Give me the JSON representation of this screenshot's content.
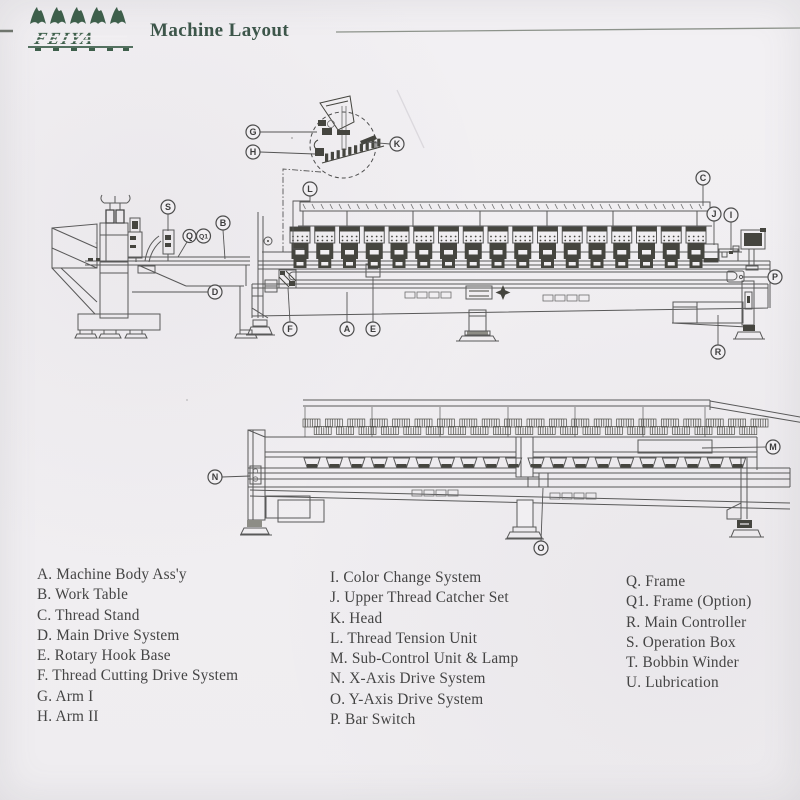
{
  "header": {
    "brand": "FEIYA",
    "title": "Machine Layout"
  },
  "legend": {
    "columns": [
      {
        "items": [
          "A. Machine Body Ass'y",
          "B. Work Table",
          "C. Thread Stand",
          "D. Main Drive System",
          "E. Rotary Hook Base",
          "F. Thread Cutting Drive System",
          "G. Arm I",
          "H. Arm II"
        ]
      },
      {
        "items": [
          "I. Color Change System",
          "J. Upper Thread Catcher Set",
          "K. Head",
          "L. Thread Tension Unit",
          "M. Sub-Control Unit & Lamp",
          "N. X-Axis Drive System",
          "O. Y-Axis Drive System",
          "P. Bar Switch"
        ]
      },
      {
        "items": [
          "Q. Frame",
          "Q1. Frame (Option)",
          "R. Main Controller",
          "S. Operation Box",
          "T. Bobbin Winder",
          "U. Lubrication"
        ]
      }
    ]
  },
  "diagram": {
    "machine": {
      "heads": 17,
      "thread_cone_groups": 41,
      "hook_bases": 20
    },
    "callouts": [
      {
        "letter": "G",
        "x": 253,
        "y": 132,
        "r": 7,
        "leader": [
          260,
          132,
          317,
          132
        ]
      },
      {
        "letter": "H",
        "x": 253,
        "y": 152,
        "r": 7,
        "leader": [
          260,
          152,
          315,
          154
        ]
      },
      {
        "letter": "K",
        "x": 397,
        "y": 144,
        "r": 7,
        "leader": [
          390,
          144,
          367,
          142
        ]
      },
      {
        "letter": "L",
        "x": 310,
        "y": 189,
        "r": 7,
        "leader": [
          310,
          196,
          310,
          201,
          293,
          201,
          293,
          249,
          304,
          249
        ]
      },
      {
        "letter": "C",
        "x": 703,
        "y": 178,
        "r": 7,
        "leader": [
          703,
          185,
          703,
          206
        ]
      },
      {
        "letter": "J",
        "x": 714,
        "y": 214,
        "r": 7,
        "leader": [
          714,
          221,
          714,
          245
        ]
      },
      {
        "letter": "I",
        "x": 731,
        "y": 215,
        "r": 7,
        "leader": [
          731,
          222,
          731,
          250
        ]
      },
      {
        "letter": "P",
        "x": 775,
        "y": 277,
        "r": 7,
        "leader": [
          768,
          277,
          742,
          277
        ]
      },
      {
        "letter": "S",
        "x": 168,
        "y": 207,
        "r": 7,
        "leader": [
          168,
          214,
          168,
          231
        ]
      },
      {
        "letter": "Q",
        "x": 189.5,
        "y": 236,
        "r": 6.5,
        "leader": [
          187,
          242,
          178,
          257
        ]
      },
      {
        "letter": "Q1",
        "x": 203.5,
        "y": 236,
        "r": 7,
        "leader": []
      },
      {
        "letter": "B",
        "x": 223,
        "y": 223,
        "r": 7,
        "leader": [
          223,
          230,
          225,
          259
        ]
      },
      {
        "letter": "D",
        "x": 215,
        "y": 292,
        "r": 7,
        "leader": [
          208,
          292,
          132,
          292
        ]
      },
      {
        "letter": "F",
        "x": 290,
        "y": 329,
        "r": 7,
        "leader": [
          290,
          322,
          288,
          288
        ]
      },
      {
        "letter": "A",
        "x": 347,
        "y": 329,
        "r": 7,
        "leader": [
          347,
          322,
          347,
          292
        ]
      },
      {
        "letter": "E",
        "x": 373,
        "y": 329,
        "r": 7,
        "leader": [
          373,
          322,
          373,
          277
        ]
      },
      {
        "letter": "R",
        "x": 718,
        "y": 352,
        "r": 7,
        "leader": [
          718,
          345,
          718,
          315
        ]
      },
      {
        "letter": "N",
        "x": 215,
        "y": 477,
        "r": 7,
        "leader": [
          222,
          477,
          250,
          476
        ]
      },
      {
        "letter": "M",
        "x": 773,
        "y": 447,
        "r": 7,
        "leader": [
          766,
          447,
          702,
          448
        ]
      },
      {
        "letter": "O",
        "x": 541,
        "y": 548,
        "r": 7,
        "leader": [
          541,
          541,
          543,
          488
        ]
      }
    ]
  },
  "colors": {
    "ink": "#595959",
    "dark": "#45453f",
    "paper": "#f1eff2",
    "brand_green": "#3e5f4b",
    "title_green": "#3d564a"
  }
}
